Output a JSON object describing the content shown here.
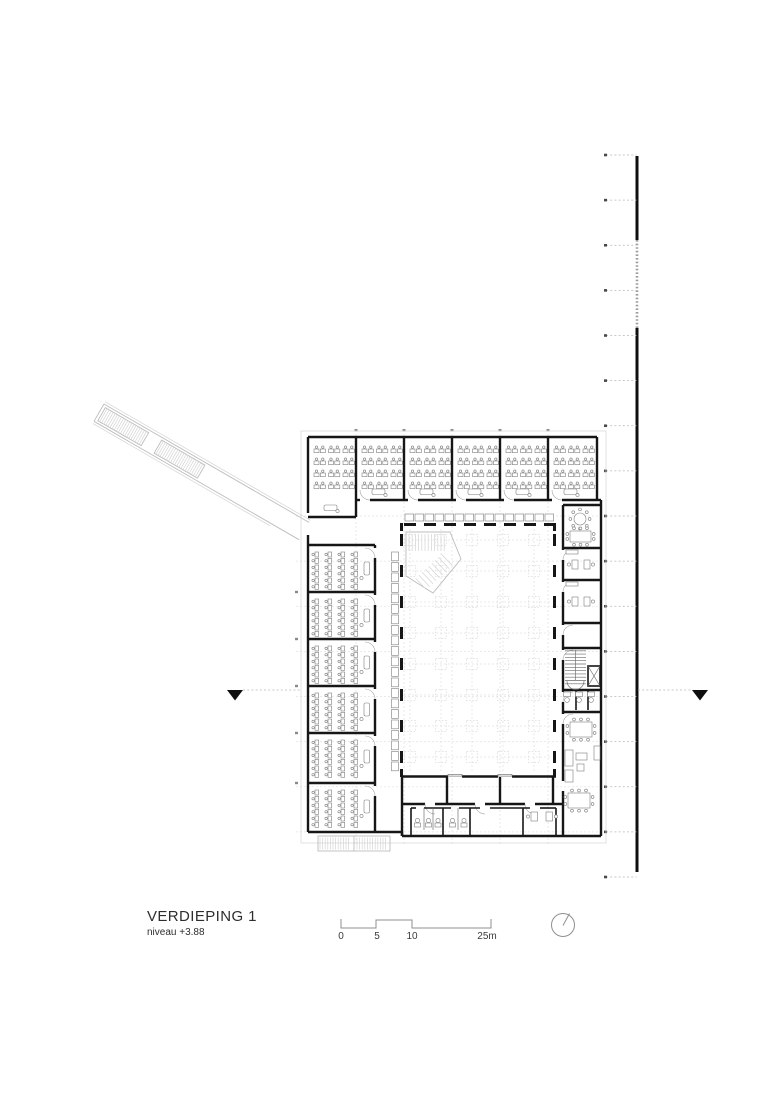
{
  "title_block": {
    "title": "VERDIEPING 1",
    "level": "niveau +3.88"
  },
  "scale_bar": {
    "labels": [
      "0",
      "5",
      "10",
      "25m"
    ],
    "unit": "m"
  },
  "north_arrow": {
    "icon": "north-arrow-icon"
  },
  "plan": {
    "top_wing_classrooms": 6,
    "left_wing_classrooms": 6,
    "boundary_ticks": 17
  },
  "colors": {
    "wall": "#161616",
    "light_line": "#bdbdbd",
    "grid": "#e3e3e3",
    "text": "#2e2e2e"
  }
}
